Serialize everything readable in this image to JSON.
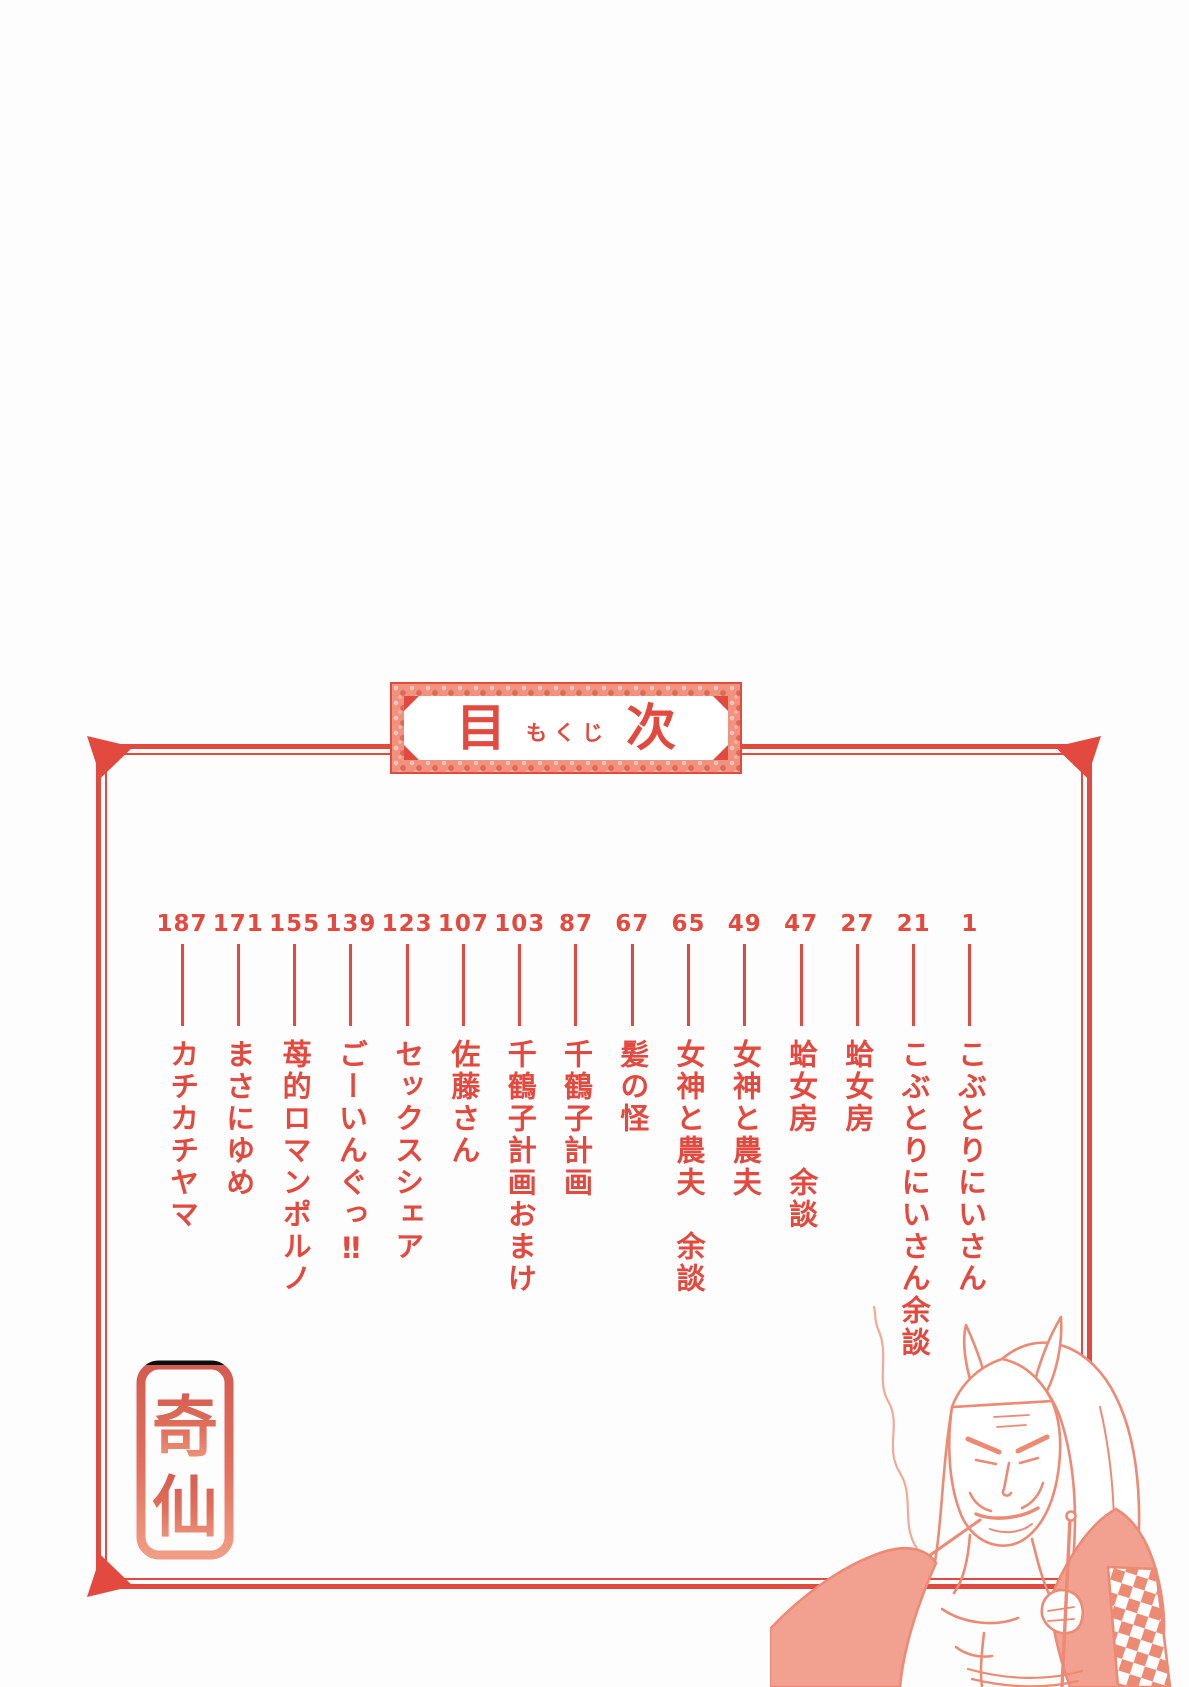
{
  "accent_color": "#e2493f",
  "title_box": {
    "main_left": "目",
    "ruby": "もくじ",
    "main_right": "次"
  },
  "toc": {
    "entries": [
      {
        "page": "1",
        "title": "こぶとりにいさん"
      },
      {
        "page": "21",
        "title": "こぶとりにいさん余談"
      },
      {
        "page": "27",
        "title": "蛤女房"
      },
      {
        "page": "47",
        "title": "蛤女房　余談"
      },
      {
        "page": "49",
        "title": "女神と農夫"
      },
      {
        "page": "65",
        "title": "女神と農夫　余談"
      },
      {
        "page": "67",
        "title": "髪の怪"
      },
      {
        "page": "87",
        "title": "千鶴子計画"
      },
      {
        "page": "103",
        "title": "千鶴子計画おまけ"
      },
      {
        "page": "107",
        "title": "佐藤さん"
      },
      {
        "page": "123",
        "title": "セックスシェア"
      },
      {
        "page": "139",
        "title": "ごーいんぐっ‼"
      },
      {
        "page": "155",
        "title": "苺的ロマンポルノ"
      },
      {
        "page": "171",
        "title": "まさにゆめ"
      },
      {
        "page": "187",
        "title": "カチカチヤマ"
      }
    ]
  },
  "stamp": {
    "char_top": "奇",
    "char_bottom": "仙"
  },
  "illustration": {
    "name": "oni-smoking-kiseru"
  }
}
